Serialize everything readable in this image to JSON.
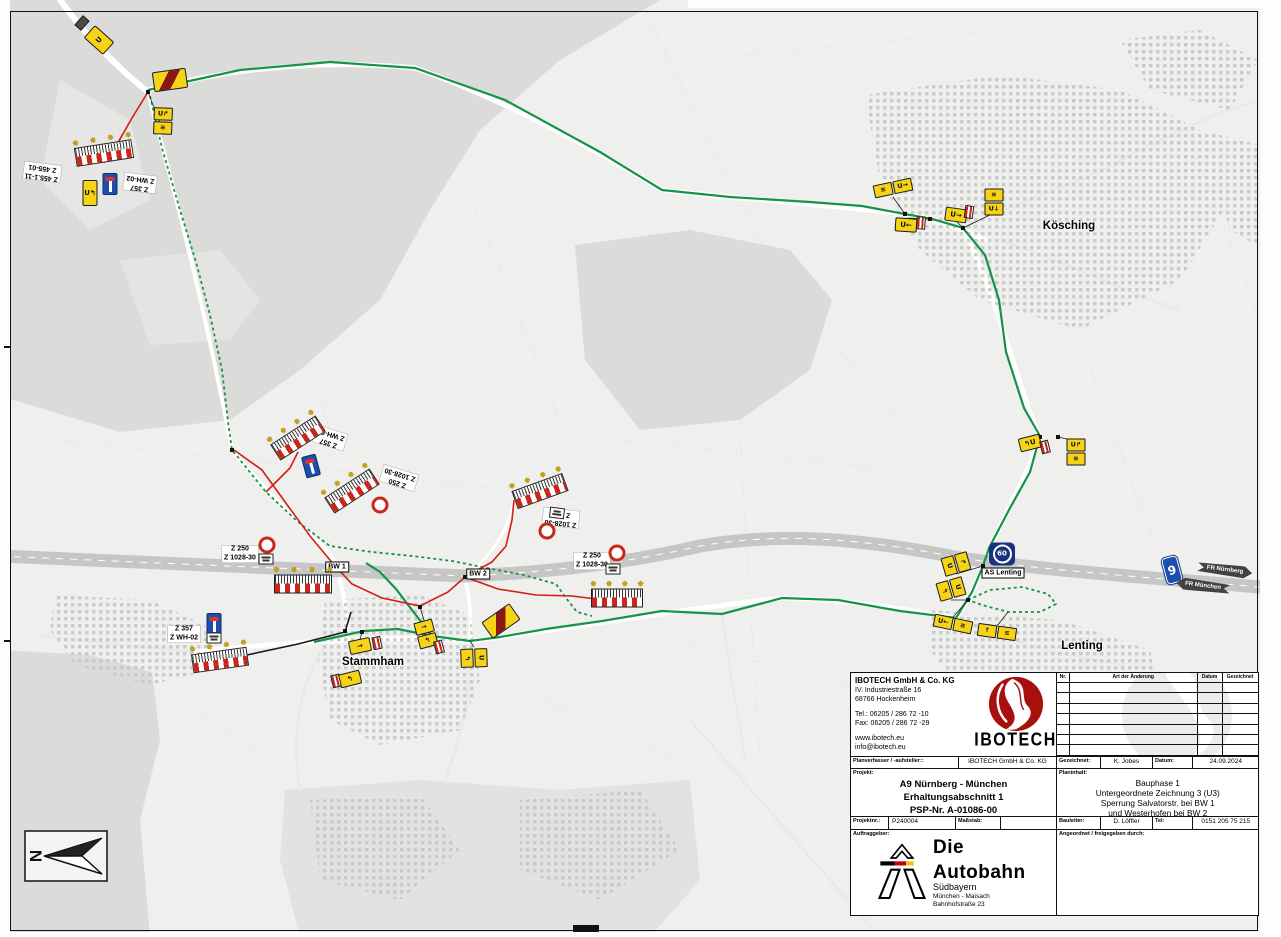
{
  "plan": {
    "north_label": "N",
    "company": {
      "name": "IBOTECH GmbH & Co. KG",
      "street": "IV. Industriestraße 16",
      "city": "68766 Hockenheim",
      "tel": "Tel.: 06205 / 286 72 -10",
      "fax": "Fax: 06205 / 286 72 -29",
      "web": "www.ibotech.eu",
      "email": "info@ibotech.eu",
      "logo_text": "IBOTECH"
    },
    "changelog": {
      "headers": [
        "Nr.",
        "Art der Änderung",
        "Datum",
        "Gezeichnet"
      ],
      "empty_rows": 7
    },
    "fields": {
      "planverfasser_label": "Planverfasser / -aufsteller::",
      "planverfasser_value": "IBOTECH GmbH & Co. KG",
      "gezeichnet_label": "Gezeichnet:",
      "gezeichnet_value": "K. Jobes",
      "datum_label": "Datum:",
      "datum_value": "24.09.2024",
      "projekt_label": "Projekt:",
      "projekt_lines": [
        "A9 Nürnberg - München",
        "Erhaltungsabschnitt 1",
        "PSP-Nr. A-01086-00"
      ],
      "planinhalt_label": "Planinhalt:",
      "planinhalt_lines": [
        "Bauphase 1",
        "Untergeordnete Zeichnung 3 (U3)",
        "Sperrung Salvatorstr. bei BW 1",
        "und Westerhofen bei BW 2"
      ],
      "projektnr_label": "Projektnr.:",
      "projektnr_value": "P240004",
      "massstab_label": "Maßstab:",
      "massstab_value": "",
      "bauleiter_label": "Bauleiter:",
      "bauleiter_value": "D. Löffler",
      "tel_label": "Tel:",
      "tel_value": "0151 205 75 215",
      "auftraggeber_label": "Auftraggeber:",
      "angeordnet_label": "Angeordnet / freigegeben durch:"
    },
    "client": {
      "line1": "Die",
      "line2": "Autobahn",
      "line3": "Südbayern",
      "line4": "München - Maisach",
      "line5": "Bahnhofstraße 23"
    }
  },
  "map": {
    "colors": {
      "detour_green": "#149447",
      "closure_red": "#d21e14",
      "sign_yellow": "#f6d317",
      "autobahn_blue": "#1b4fae"
    },
    "towns": [
      {
        "text": "Kösching",
        "x": 1069,
        "y": 226
      },
      {
        "text": "Lenting",
        "x": 1082,
        "y": 646
      },
      {
        "text": "Stammham",
        "x": 373,
        "y": 662
      }
    ],
    "labels": [
      {
        "x": 42,
        "y": 172,
        "r": 187,
        "cls": "z",
        "lines": [
          "Z 455.1-11",
          "Z 455-01"
        ]
      },
      {
        "x": 140,
        "y": 183,
        "r": 187,
        "cls": "z",
        "lines": [
          "Z 357",
          "Z WH-02"
        ]
      },
      {
        "x": 330,
        "y": 438,
        "r": 197,
        "cls": "z",
        "lines": [
          "Z 357",
          "Z WH-02"
        ]
      },
      {
        "x": 399,
        "y": 478,
        "r": 197,
        "cls": "z",
        "lines": [
          "Z 250",
          "Z 1028-30"
        ]
      },
      {
        "x": 561,
        "y": 518,
        "r": 186,
        "cls": "z",
        "lines": [
          "Z 1028-30",
          "Z 250"
        ]
      },
      {
        "x": 240,
        "y": 554,
        "r": 0,
        "cls": "z",
        "lines": [
          "Z 250",
          "Z 1028-30"
        ]
      },
      {
        "x": 592,
        "y": 561,
        "r": 0,
        "cls": "z",
        "lines": [
          "Z 250",
          "Z 1028-30"
        ]
      },
      {
        "x": 184,
        "y": 634,
        "r": 0,
        "cls": "z",
        "lines": [
          "Z 357",
          "Z WH-02"
        ]
      },
      {
        "x": 337,
        "y": 567,
        "r": 0,
        "cls": "box",
        "lines": [
          "BW 1"
        ]
      },
      {
        "x": 478,
        "y": 574,
        "r": 0,
        "cls": "box",
        "lines": [
          "BW 2"
        ]
      },
      {
        "x": 1003,
        "y": 573,
        "r": 0,
        "cls": "box",
        "lines": [
          "AS Lenting"
        ]
      }
    ],
    "signs": [
      {
        "t": "plate-dark",
        "x": 82,
        "y": 23,
        "r": -48
      },
      {
        "t": "detour",
        "x": 99,
        "y": 40,
        "r": -48,
        "w": 17,
        "h": 26,
        "g": "U"
      },
      {
        "t": "detour-end",
        "x": 170,
        "y": 80,
        "r": -8
      },
      {
        "t": "detour2v",
        "x": 163,
        "y": 121,
        "r": 2,
        "g": "U↱",
        "g2": "≡"
      },
      {
        "t": "barrier",
        "x": 104,
        "y": 153,
        "r": -9,
        "w": 58
      },
      {
        "t": "detour",
        "x": 90,
        "y": 193,
        "r": 0,
        "w": 15,
        "h": 26,
        "g": "U↰"
      },
      {
        "t": "z357",
        "x": 110,
        "y": 184,
        "r": 0
      },
      {
        "t": "barrier",
        "x": 298,
        "y": 438,
        "r": -33,
        "w": 54
      },
      {
        "t": "z357",
        "x": 311,
        "y": 466,
        "r": -15
      },
      {
        "t": "barrier",
        "x": 352,
        "y": 491,
        "r": -33,
        "w": 54
      },
      {
        "t": "z250",
        "x": 380,
        "y": 505,
        "r": 0
      },
      {
        "t": "z250",
        "x": 267,
        "y": 545,
        "r": 0
      },
      {
        "t": "plate",
        "x": 266,
        "y": 559,
        "r": 0
      },
      {
        "t": "barrier",
        "x": 303,
        "y": 584,
        "r": 0,
        "w": 58
      },
      {
        "t": "z357",
        "x": 214,
        "y": 624,
        "r": 0
      },
      {
        "t": "plate",
        "x": 214,
        "y": 638,
        "r": 0
      },
      {
        "t": "barrier",
        "x": 220,
        "y": 660,
        "r": -8,
        "w": 56
      },
      {
        "t": "barrier",
        "x": 540,
        "y": 491,
        "r": -20,
        "w": 54
      },
      {
        "t": "plate",
        "x": 557,
        "y": 513,
        "r": 187
      },
      {
        "t": "z250",
        "x": 547,
        "y": 531,
        "r": 0
      },
      {
        "t": "z250",
        "x": 617,
        "y": 553,
        "r": 0
      },
      {
        "t": "plate",
        "x": 613,
        "y": 569,
        "r": 0
      },
      {
        "t": "barrier",
        "x": 617,
        "y": 598,
        "r": 0,
        "w": 52
      },
      {
        "t": "detour",
        "x": 360,
        "y": 646,
        "r": -12,
        "g": "→"
      },
      {
        "t": "plate-striped",
        "x": 377,
        "y": 643,
        "r": -12
      },
      {
        "t": "detour",
        "x": 350,
        "y": 679,
        "r": -14,
        "g": "↰"
      },
      {
        "t": "plate-striped",
        "x": 336,
        "y": 681,
        "r": -14
      },
      {
        "t": "detour2v",
        "x": 426,
        "y": 634,
        "r": -15,
        "g": "→",
        "g2": "↰"
      },
      {
        "t": "plate-striped",
        "x": 439,
        "y": 647,
        "r": -15
      },
      {
        "t": "detour-end",
        "x": 501,
        "y": 621,
        "r": -35
      },
      {
        "t": "detour2v",
        "x": 474,
        "y": 658,
        "r": 88,
        "g": "U",
        "g2": "↰"
      },
      {
        "t": "detour2v",
        "x": 956,
        "y": 564,
        "r": 74,
        "g": "↱",
        "g2": "U"
      },
      {
        "t": "detour2v",
        "x": 951,
        "y": 589,
        "r": 74,
        "g": "U",
        "g2": "↰"
      },
      {
        "t": "badge60",
        "x": 1002,
        "y": 554,
        "r": 0,
        "g": "60"
      },
      {
        "t": "detour2h",
        "x": 953,
        "y": 624,
        "r": 12,
        "g": "U←",
        "g2": "≡"
      },
      {
        "t": "detour2h",
        "x": 997,
        "y": 632,
        "r": 8,
        "g": "↑",
        "g2": "≡"
      },
      {
        "t": "detour",
        "x": 1030,
        "y": 443,
        "r": -14,
        "g": "↰U"
      },
      {
        "t": "plate-striped",
        "x": 1045,
        "y": 447,
        "r": -14
      },
      {
        "t": "detour2v",
        "x": 1076,
        "y": 452,
        "r": 0,
        "g": "U↱",
        "g2": "≡"
      },
      {
        "t": "detour2h",
        "x": 893,
        "y": 188,
        "r": -12,
        "g": "≡",
        "g2": "U→"
      },
      {
        "t": "detour",
        "x": 906,
        "y": 225,
        "r": 4,
        "g": "U←"
      },
      {
        "t": "plate-striped",
        "x": 921,
        "y": 223,
        "r": 4
      },
      {
        "t": "detour",
        "x": 956,
        "y": 215,
        "r": 8,
        "g": "U→"
      },
      {
        "t": "plate-striped",
        "x": 969,
        "y": 212,
        "r": 8
      },
      {
        "t": "detour2v",
        "x": 994,
        "y": 202,
        "r": 0,
        "g": "≡",
        "g2": "U↓"
      },
      {
        "t": "badgeA",
        "x": 1172,
        "y": 570,
        "r": -15,
        "g": "9"
      },
      {
        "t": "dirarrow",
        "x": 1225,
        "y": 570,
        "r": 7,
        "g": "FR Nürnberg",
        "dir": "right"
      },
      {
        "t": "dirarrow",
        "x": 1203,
        "y": 586,
        "r": 7,
        "g": "FR München",
        "dir": "left"
      }
    ],
    "routes": [
      {
        "id": "detour-route-main",
        "c": "#149447",
        "w": 2.2,
        "d": "M148,90 L240,70 L330,62 L415,68 L505,100 L600,152 L662,190 L730,197 L810,202 L862,206 L905,214 L932,219 L963,228 L985,255 L999,300 L1006,352 L1024,408 L1040,436 L1030,472 L1010,508 L989,548 L983,566 L972,592 L956,618 L900,611 L838,600 L782,598 L722,614 L662,611 L602,621 L546,629 L500,637 L470,641 L432,636 L412,610 L396,589 L380,572 L366,563"
      },
      {
        "id": "detour-route-west",
        "c": "#149447",
        "w": 2.2,
        "d": "M432,636 L398,629 L364,631 L332,638 L314,642"
      },
      {
        "id": "detour-route-dashed",
        "c": "#149447",
        "w": 1.8,
        "dash": "3 3",
        "d": "M150,96 L162,148 L180,210 L196,262 L210,315 L222,370 L228,422 L232,450 L266,492 L298,522 L330,546 L372,552 L412,556 L452,561 L492,569 L524,575 L556,584 L566,598 L577,612 L592,616"
      },
      {
        "id": "detour-loop-dashed",
        "c": "#149447",
        "w": 1.8,
        "dash": "3 3",
        "d": "M968,600 L990,590 L1022,587 L1048,594 L1056,604 L1040,612 L1008,612 L982,605 L968,600"
      },
      {
        "id": "closure-1",
        "c": "#d21e14",
        "w": 1.6,
        "d": "M148,92 L132,118 L116,146"
      },
      {
        "id": "closure-2",
        "c": "#d21e14",
        "w": 1.6,
        "d": "M234,450 L262,470 L288,506 L310,536 L330,560 L337,568 L352,584 L382,598 L420,606 L448,592 L465,577 L492,562 L506,546 L512,520 L514,500"
      },
      {
        "id": "closure-3",
        "c": "#d21e14",
        "w": 1.6,
        "d": "M465,577 L498,589 L536,595 L572,596 L596,599"
      },
      {
        "id": "closure-4",
        "c": "#d21e14",
        "w": 1.6,
        "d": "M266,492 L290,468 L298,452"
      },
      {
        "id": "closed-street-black",
        "c": "#1a1a1a",
        "w": 1.6,
        "d": "M247,655 L298,644 L345,632 L351,612"
      }
    ],
    "connectors": [
      [
        163,
        131,
        148,
        92
      ],
      [
        104,
        163,
        116,
        146
      ],
      [
        893,
        197,
        905,
        214
      ],
      [
        908,
        218,
        930,
        219
      ],
      [
        956,
        221,
        963,
        228
      ],
      [
        994,
        213,
        963,
        228
      ],
      [
        1030,
        450,
        1040,
        437
      ],
      [
        1076,
        441,
        1058,
        437
      ],
      [
        956,
        574,
        983,
        566
      ],
      [
        951,
        600,
        968,
        600
      ],
      [
        953,
        617,
        968,
        600
      ],
      [
        997,
        626,
        1008,
        612
      ],
      [
        360,
        640,
        362,
        632
      ],
      [
        426,
        627,
        420,
        607
      ],
      [
        474,
        647,
        470,
        641
      ],
      [
        247,
        658,
        247,
        655
      ]
    ],
    "dots": [
      [
        148,
        92
      ],
      [
        232,
        450
      ],
      [
        337,
        568
      ],
      [
        465,
        577
      ],
      [
        905,
        214
      ],
      [
        930,
        219
      ],
      [
        963,
        228
      ],
      [
        983,
        566
      ],
      [
        968,
        600
      ],
      [
        1040,
        437
      ],
      [
        1058,
        437
      ],
      [
        362,
        632
      ],
      [
        420,
        607
      ],
      [
        345,
        631
      ],
      [
        596,
        599
      ]
    ]
  }
}
